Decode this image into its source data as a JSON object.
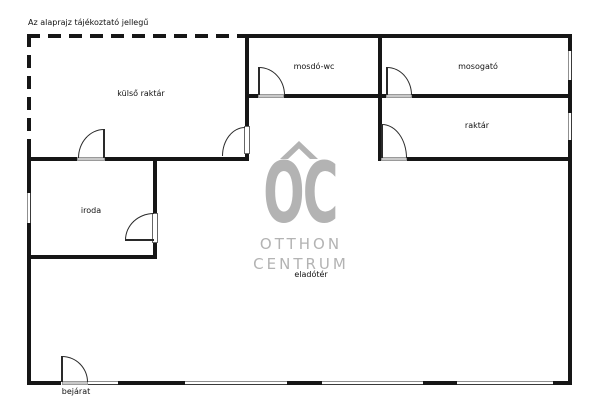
{
  "note": "Az alaprajz tájékoztató jellegű",
  "rooms": {
    "kulso_raktar": "külső raktár",
    "mosdo_wc": "mosdó-wc",
    "mosogato": "mosogató",
    "raktar": "raktár",
    "iroda": "iroda",
    "eladoter": "eladótér",
    "bejarat": "bejárat"
  },
  "watermark": {
    "monogram": "OC",
    "line1": "OTTHON",
    "line2": "CENTRUM",
    "color": "#b3b3b3"
  },
  "colors": {
    "wall": "#161616",
    "door_threshold": "#c9c9c9",
    "background": "#ffffff",
    "label_text": "#111111"
  }
}
